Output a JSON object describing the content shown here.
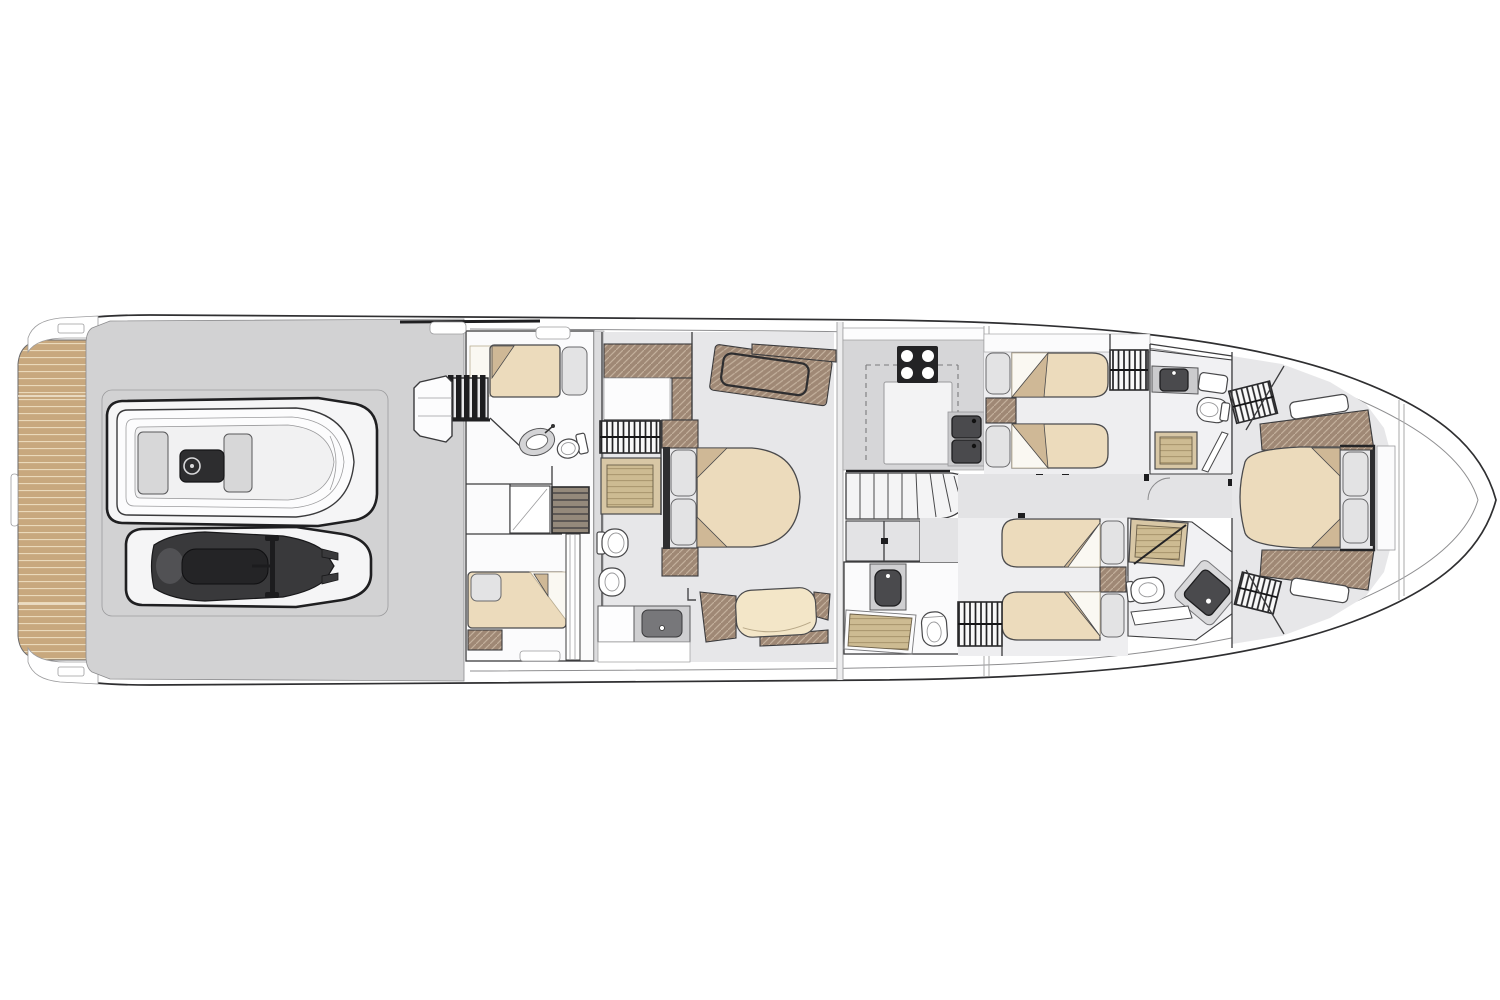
{
  "palette": {
    "background": "#ffffff",
    "line_dark": "#2f2f31",
    "wall": "#3c3c3e",
    "deck_gray": "#d2d2d3",
    "floor_light": "#e7e7e9",
    "corridor": "#e3e3e5",
    "galley_floor": "#d6d6d8",
    "room_white": "#fbfbfc",
    "teak": "#c8a87e",
    "teak_line": "#ead9ba",
    "wood": "#9f8875",
    "wood_line": "#c3b09c",
    "shower_teak": "#d8c7a5",
    "grate": "#cdbb92",
    "grate_line": "#a8946c",
    "bed": "#ecdbbc",
    "bed_fold": "#cfb896",
    "pillow": "#e3e3e4",
    "fixture_dark": "#4a4a4d",
    "equipment": "#2d2d2f",
    "counter_gray": "#cfcfd1"
  },
  "deck_plan": {
    "type": "yacht-lower-deck-floor-plan",
    "orientation": "bow-right-stern-left",
    "areas": [
      {
        "name": "swim-platform",
        "fixtures": [
          "teak-decking"
        ]
      },
      {
        "name": "tender-garage",
        "fixtures": [
          "tender-with-console",
          "jet-ski"
        ]
      },
      {
        "name": "crew-quarters",
        "fixtures": [
          "companionway-steps",
          "berth",
          "berth",
          "sink",
          "toilet",
          "lockers",
          "engine-room-hatch",
          "ladder-trunk"
        ]
      },
      {
        "name": "master-cabin",
        "fixtures": [
          "double-bed",
          "pillow",
          "pillow",
          "nightstand",
          "nightstand",
          "vanity-desk",
          "sofa",
          "wardrobe-hanging-rail"
        ]
      },
      {
        "name": "master-bathroom",
        "fixtures": [
          "shower",
          "toilet",
          "bidet",
          "sink-vanity"
        ]
      },
      {
        "name": "galley",
        "fixtures": [
          "cooktop-4-burner",
          "island-counter",
          "double-sink",
          "counter-outline"
        ]
      },
      {
        "name": "staircase",
        "fixtures": [
          "straight-treads",
          "winder-treads"
        ]
      },
      {
        "name": "day-head",
        "fixtures": [
          "sink-vanity",
          "shower",
          "toilet"
        ]
      },
      {
        "name": "twin-cabin-starboard",
        "fixtures": [
          "single-bed",
          "single-bed",
          "pillow",
          "pillow",
          "nightstand",
          "wardrobe-hanging-rail"
        ]
      },
      {
        "name": "bathroom-forward-starboard",
        "fixtures": [
          "sink-vanity",
          "shelf",
          "toilet",
          "shower",
          "door-panel"
        ]
      },
      {
        "name": "twin-cabin-port",
        "fixtures": [
          "single-bed",
          "single-bed",
          "pillow",
          "pillow",
          "nightstand",
          "wardrobe-hanging-rail"
        ]
      },
      {
        "name": "shower-room-port",
        "fixtures": [
          "teak-shower",
          "glass-door",
          "toilet",
          "shower-tray",
          "bench"
        ]
      },
      {
        "name": "vip-cabin",
        "fixtures": [
          "double-bed",
          "pillow",
          "pillow",
          "wardrobe-hanging-rail",
          "wardrobe-hanging-rail",
          "hull-window",
          "hull-window",
          "side-unit",
          "side-unit"
        ]
      },
      {
        "name": "corridor",
        "fixtures": [
          "door",
          "door",
          "door",
          "door"
        ]
      },
      {
        "name": "foredeck",
        "fixtures": []
      }
    ]
  }
}
